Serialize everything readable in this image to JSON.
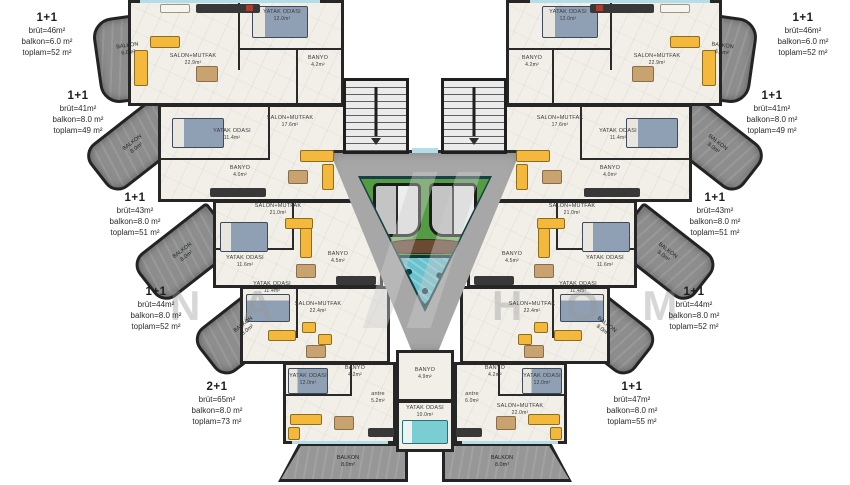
{
  "units": [
    {
      "id": "L1",
      "type": "1+1",
      "brut": "brüt=46m²",
      "balkon": "balkon=6.0 m²",
      "toplam": "toplam=52 m²"
    },
    {
      "id": "L2",
      "type": "1+1",
      "brut": "brüt=41m²",
      "balkon": "balkon=8.0 m²",
      "toplam": "toplam=49 m²"
    },
    {
      "id": "L3",
      "type": "1+1",
      "brut": "brüt=43m²",
      "balkon": "balkon=8.0 m²",
      "toplam": "toplam=51 m²"
    },
    {
      "id": "L4",
      "type": "1+1",
      "brut": "brüt=44m²",
      "balkon": "balkon=8.0 m²",
      "toplam": "toplam=52 m²"
    },
    {
      "id": "L5",
      "type": "2+1",
      "brut": "brüt=65m²",
      "balkon": "balkon=8.0 m²",
      "toplam": "toplam=73 m²"
    },
    {
      "id": "R1",
      "type": "1+1",
      "brut": "brüt=46m²",
      "balkon": "balkon=6.0 m²",
      "toplam": "toplam=52 m²"
    },
    {
      "id": "R2",
      "type": "1+1",
      "brut": "brüt=41m²",
      "balkon": "balkon=8.0 m²",
      "toplam": "toplam=49 m²"
    },
    {
      "id": "R3",
      "type": "1+1",
      "brut": "brüt=43m²",
      "balkon": "balkon=8.0 m²",
      "toplam": "toplam=51 m²"
    },
    {
      "id": "R4",
      "type": "1+1",
      "brut": "brüt=44m²",
      "balkon": "balkon=8.0 m²",
      "toplam": "toplam=52 m²"
    },
    {
      "id": "R5",
      "type": "1+1",
      "brut": "brüt=47m²",
      "balkon": "balkon=8.0 m²",
      "toplam": "toplam=55 m²"
    }
  ],
  "rooms": [
    {
      "name": "SALON+MUTFAK",
      "area": "22.9m²"
    },
    {
      "name": "YATAK ODASI",
      "area": "12.0m²"
    },
    {
      "name": "BANYO",
      "area": "4.2m²"
    },
    {
      "name": "BALKON",
      "area": "6.0m²"
    },
    {
      "name": "YATAK ODASI",
      "area": "11.4m²"
    },
    {
      "name": "SALON+MUTFAK",
      "area": "17.6m²"
    },
    {
      "name": "BANYO",
      "area": "4.0m²"
    },
    {
      "name": "BALKON",
      "area": "8.0m²"
    },
    {
      "name": "SALON+MUTFAK",
      "area": "21.0m²"
    },
    {
      "name": "YATAK ODASI",
      "area": "11.6m²"
    },
    {
      "name": "BANYO",
      "area": "4.5m²"
    },
    {
      "name": "SALON+MUTFAK",
      "area": "22.4m²"
    },
    {
      "name": "BANYO",
      "area": "4.9m²"
    },
    {
      "name": "YATAK ODASI",
      "area": "10.0m²"
    },
    {
      "name": "antre",
      "area": "5.2m²"
    },
    {
      "name": "antre",
      "area": "6.0m²"
    },
    {
      "name": "SALON+MUTFAK",
      "area": "22.0m²"
    }
  ],
  "watermark": {
    "left": "N A",
    "right": "H O M"
  }
}
